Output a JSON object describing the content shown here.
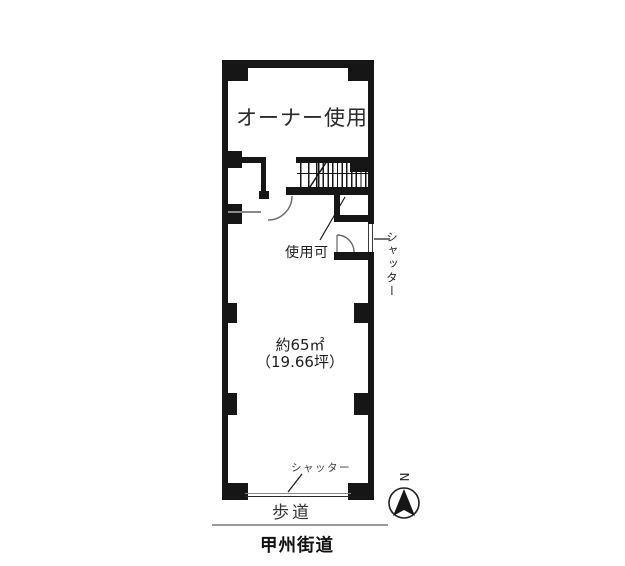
{
  "floor_plan": {
    "owner_area": {
      "label": "オーナー使用"
    },
    "stairs": {
      "usable_label": "使用可"
    },
    "side_entrance": {
      "shutter_label": "シャッター"
    },
    "main_room": {
      "area_sqm_label": "約65㎡",
      "area_tsubo_label": "（19.66坪）",
      "area_sqm": 65,
      "area_tsubo": 19.66
    },
    "front": {
      "shutter_label": "シャッター",
      "sidewalk_label": "歩道",
      "road_label": "甲州街道"
    },
    "compass": {
      "north_label": "N"
    },
    "colors": {
      "wall": "#161616",
      "door_arc": "#666666",
      "shutter_line": "#3a3a3a",
      "front_shutter_gray": "#8a8a8a",
      "road_divider": "#9a9a9a"
    }
  }
}
